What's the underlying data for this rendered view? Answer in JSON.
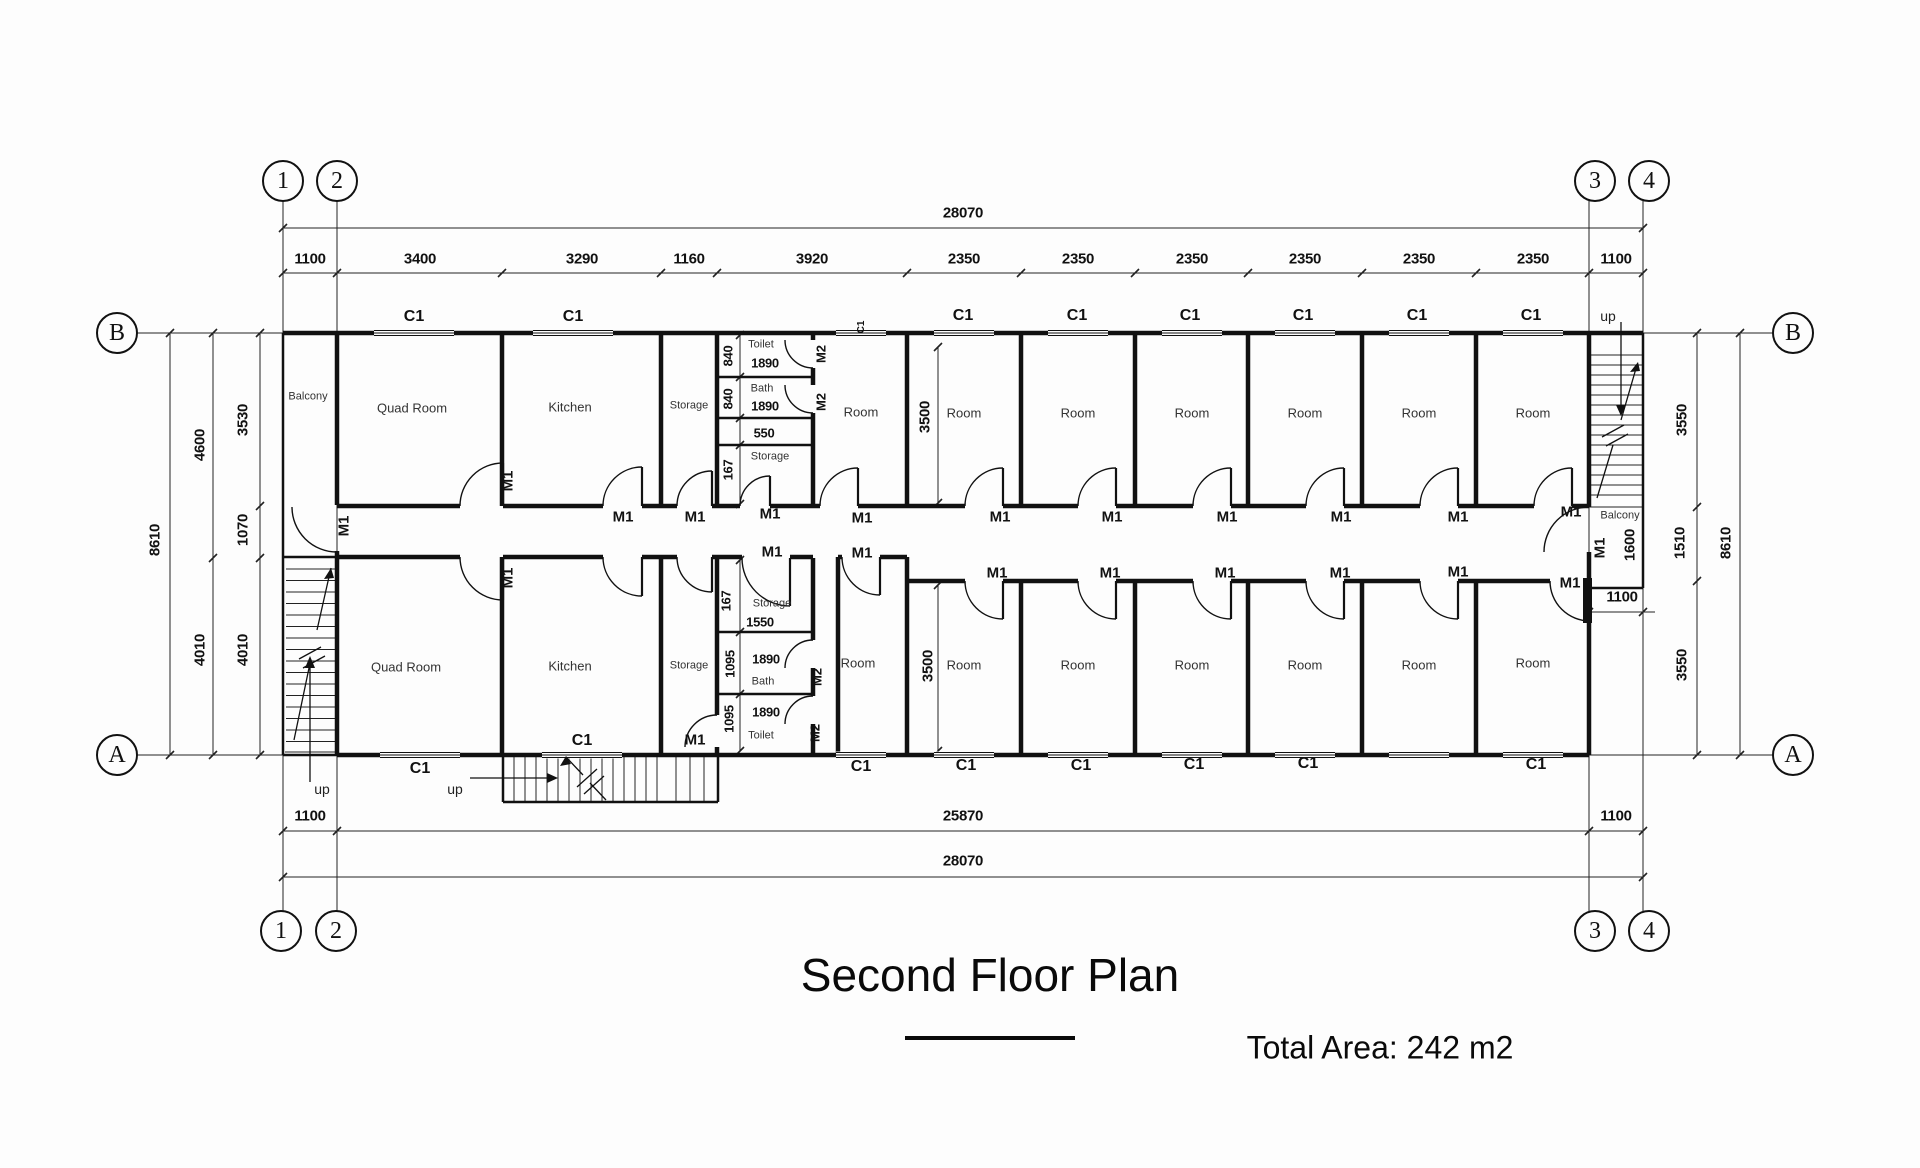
{
  "title": {
    "text": "Second Floor Plan",
    "total_area": "Total Area: 242 m2"
  },
  "plan": {
    "bubbles": [
      {
        "t": "1",
        "x": 283,
        "y": 181
      },
      {
        "t": "2",
        "x": 337,
        "y": 181
      },
      {
        "t": "3",
        "x": 1595,
        "y": 181
      },
      {
        "t": "4",
        "x": 1649,
        "y": 181
      },
      {
        "t": "1",
        "x": 281,
        "y": 931
      },
      {
        "t": "2",
        "x": 336,
        "y": 931
      },
      {
        "t": "3",
        "x": 1595,
        "y": 931
      },
      {
        "t": "4",
        "x": 1649,
        "y": 931
      },
      {
        "t": "B",
        "x": 117,
        "y": 333
      },
      {
        "t": "A",
        "x": 117,
        "y": 755
      },
      {
        "t": "B",
        "x": 1793,
        "y": 333
      },
      {
        "t": "A",
        "x": 1793,
        "y": 755
      }
    ],
    "labels": [
      {
        "t": "28070",
        "x": 963,
        "y": 213,
        "k": "d"
      },
      {
        "t": "1100",
        "x": 310,
        "y": 259,
        "k": "d"
      },
      {
        "t": "3400",
        "x": 420,
        "y": 259,
        "k": "d"
      },
      {
        "t": "3290",
        "x": 582,
        "y": 259,
        "k": "d"
      },
      {
        "t": "1160",
        "x": 689,
        "y": 259,
        "k": "d"
      },
      {
        "t": "3920",
        "x": 812,
        "y": 259,
        "k": "d"
      },
      {
        "t": "2350",
        "x": 964,
        "y": 259,
        "k": "d"
      },
      {
        "t": "2350",
        "x": 1078,
        "y": 259,
        "k": "d"
      },
      {
        "t": "2350",
        "x": 1192,
        "y": 259,
        "k": "d"
      },
      {
        "t": "2350",
        "x": 1305,
        "y": 259,
        "k": "d"
      },
      {
        "t": "2350",
        "x": 1419,
        "y": 259,
        "k": "d"
      },
      {
        "t": "2350",
        "x": 1533,
        "y": 259,
        "k": "d"
      },
      {
        "t": "1100",
        "x": 1616,
        "y": 259,
        "k": "d"
      },
      {
        "t": "8610",
        "x": 155,
        "y": 540,
        "r": -90,
        "k": "d"
      },
      {
        "t": "4600",
        "x": 200,
        "y": 445,
        "r": -90,
        "k": "d"
      },
      {
        "t": "4010",
        "x": 200,
        "y": 650,
        "r": -90,
        "k": "d"
      },
      {
        "t": "3530",
        "x": 243,
        "y": 420,
        "r": -90,
        "k": "d"
      },
      {
        "t": "1070",
        "x": 243,
        "y": 530,
        "r": -90,
        "k": "d"
      },
      {
        "t": "4010",
        "x": 243,
        "y": 650,
        "r": -90,
        "k": "d"
      },
      {
        "t": "3550",
        "x": 1682,
        "y": 420,
        "r": -90,
        "k": "d"
      },
      {
        "t": "1510",
        "x": 1680,
        "y": 543,
        "r": -90,
        "k": "d"
      },
      {
        "t": "3550",
        "x": 1682,
        "y": 665,
        "r": -90,
        "k": "d"
      },
      {
        "t": "8610",
        "x": 1726,
        "y": 543,
        "r": -90,
        "k": "d"
      },
      {
        "t": "1100",
        "x": 310,
        "y": 816,
        "k": "d"
      },
      {
        "t": "25870",
        "x": 963,
        "y": 816,
        "k": "d"
      },
      {
        "t": "1100",
        "x": 1616,
        "y": 816,
        "k": "d"
      },
      {
        "t": "28070",
        "x": 963,
        "y": 861,
        "k": "d"
      },
      {
        "t": "1100",
        "x": 1622,
        "y": 597,
        "k": "d"
      },
      {
        "t": "1600",
        "x": 1630,
        "y": 545,
        "r": -90,
        "k": "d"
      },
      {
        "t": "3500",
        "x": 925,
        "y": 417,
        "r": -90,
        "k": "d"
      },
      {
        "t": "3500",
        "x": 928,
        "y": 666,
        "r": -90,
        "k": "d"
      },
      {
        "t": "840",
        "x": 728,
        "y": 356,
        "r": -90,
        "k": "d",
        "s": 13
      },
      {
        "t": "1890",
        "x": 765,
        "y": 363,
        "k": "d",
        "s": 13
      },
      {
        "t": "840",
        "x": 728,
        "y": 399,
        "r": -90,
        "k": "d",
        "s": 13
      },
      {
        "t": "1890",
        "x": 765,
        "y": 406,
        "k": "d",
        "s": 13
      },
      {
        "t": "550",
        "x": 764,
        "y": 433,
        "k": "d",
        "s": 13
      },
      {
        "t": "167",
        "x": 728,
        "y": 470,
        "r": -90,
        "k": "d",
        "s": 13
      },
      {
        "t": "167",
        "x": 726,
        "y": 601,
        "r": -90,
        "k": "d",
        "s": 13
      },
      {
        "t": "1550",
        "x": 760,
        "y": 622,
        "k": "d",
        "s": 13
      },
      {
        "t": "1095",
        "x": 730,
        "y": 664,
        "r": -90,
        "k": "d",
        "s": 13
      },
      {
        "t": "1890",
        "x": 766,
        "y": 659,
        "k": "d",
        "s": 13
      },
      {
        "t": "1095",
        "x": 729,
        "y": 719,
        "r": -90,
        "k": "d",
        "s": 13
      },
      {
        "t": "1890",
        "x": 766,
        "y": 712,
        "k": "d",
        "s": 13
      },
      {
        "t": "Balcony",
        "x": 308,
        "y": 397,
        "k": "r",
        "s": 11
      },
      {
        "t": "Quad Room",
        "x": 412,
        "y": 408,
        "k": "r"
      },
      {
        "t": "Kitchen",
        "x": 570,
        "y": 407,
        "k": "r"
      },
      {
        "t": "Storage",
        "x": 689,
        "y": 406,
        "k": "r",
        "s": 11
      },
      {
        "t": "Room",
        "x": 861,
        "y": 412,
        "k": "r"
      },
      {
        "t": "Room",
        "x": 964,
        "y": 413,
        "k": "r"
      },
      {
        "t": "Room",
        "x": 1078,
        "y": 413,
        "k": "r"
      },
      {
        "t": "Room",
        "x": 1192,
        "y": 413,
        "k": "r"
      },
      {
        "t": "Room",
        "x": 1305,
        "y": 413,
        "k": "r"
      },
      {
        "t": "Room",
        "x": 1419,
        "y": 413,
        "k": "r"
      },
      {
        "t": "Room",
        "x": 1533,
        "y": 413,
        "k": "r"
      },
      {
        "t": "Quad Room",
        "x": 406,
        "y": 667,
        "k": "r"
      },
      {
        "t": "Kitchen",
        "x": 570,
        "y": 666,
        "k": "r"
      },
      {
        "t": "Storage",
        "x": 689,
        "y": 666,
        "k": "r",
        "s": 11
      },
      {
        "t": "Room",
        "x": 858,
        "y": 663,
        "k": "r"
      },
      {
        "t": "Room",
        "x": 964,
        "y": 665,
        "k": "r"
      },
      {
        "t": "Room",
        "x": 1078,
        "y": 665,
        "k": "r"
      },
      {
        "t": "Room",
        "x": 1192,
        "y": 665,
        "k": "r"
      },
      {
        "t": "Room",
        "x": 1305,
        "y": 665,
        "k": "r"
      },
      {
        "t": "Room",
        "x": 1419,
        "y": 665,
        "k": "r"
      },
      {
        "t": "Room",
        "x": 1533,
        "y": 663,
        "k": "r"
      },
      {
        "t": "Toilet",
        "x": 761,
        "y": 345,
        "k": "r",
        "s": 11
      },
      {
        "t": "Bath",
        "x": 762,
        "y": 389,
        "k": "r",
        "s": 11
      },
      {
        "t": "Storage",
        "x": 770,
        "y": 457,
        "k": "r",
        "s": 11
      },
      {
        "t": "Storage",
        "x": 772,
        "y": 604,
        "k": "r",
        "s": 11
      },
      {
        "t": "Bath",
        "x": 763,
        "y": 682,
        "k": "r",
        "s": 11
      },
      {
        "t": "Toilet",
        "x": 761,
        "y": 736,
        "k": "r",
        "s": 11
      },
      {
        "t": "Balcony",
        "x": 1620,
        "y": 516,
        "k": "r",
        "s": 11
      },
      {
        "t": "M1",
        "x": 623,
        "y": 517,
        "k": "m"
      },
      {
        "t": "M1",
        "x": 695,
        "y": 517,
        "k": "m"
      },
      {
        "t": "M1",
        "x": 770,
        "y": 514,
        "k": "m"
      },
      {
        "t": "M1",
        "x": 862,
        "y": 518,
        "k": "m"
      },
      {
        "t": "M1",
        "x": 1000,
        "y": 517,
        "k": "m"
      },
      {
        "t": "M1",
        "x": 1112,
        "y": 517,
        "k": "m"
      },
      {
        "t": "M1",
        "x": 1227,
        "y": 517,
        "k": "m"
      },
      {
        "t": "M1",
        "x": 1341,
        "y": 517,
        "k": "m"
      },
      {
        "t": "M1",
        "x": 1458,
        "y": 517,
        "k": "m"
      },
      {
        "t": "M1",
        "x": 1571,
        "y": 512,
        "k": "m"
      },
      {
        "t": "M1",
        "x": 772,
        "y": 552,
        "k": "m"
      },
      {
        "t": "M1",
        "x": 862,
        "y": 553,
        "k": "m"
      },
      {
        "t": "M1",
        "x": 997,
        "y": 573,
        "k": "m"
      },
      {
        "t": "M1",
        "x": 1110,
        "y": 573,
        "k": "m"
      },
      {
        "t": "M1",
        "x": 1225,
        "y": 573,
        "k": "m"
      },
      {
        "t": "M1",
        "x": 1340,
        "y": 573,
        "k": "m"
      },
      {
        "t": "M1",
        "x": 1458,
        "y": 572,
        "k": "m"
      },
      {
        "t": "M1",
        "x": 1570,
        "y": 583,
        "k": "m"
      },
      {
        "t": "M1",
        "x": 695,
        "y": 740,
        "k": "m"
      },
      {
        "t": "M1",
        "x": 344,
        "y": 526,
        "r": -90,
        "k": "m"
      },
      {
        "t": "M1",
        "x": 508,
        "y": 481,
        "r": -90,
        "k": "m"
      },
      {
        "t": "M1",
        "x": 508,
        "y": 578,
        "r": -90,
        "k": "m"
      },
      {
        "t": "M1",
        "x": 1600,
        "y": 548,
        "r": -90,
        "k": "m"
      },
      {
        "t": "M2",
        "x": 821,
        "y": 354,
        "r": -90,
        "k": "m",
        "s": 13
      },
      {
        "t": "M2",
        "x": 821,
        "y": 402,
        "r": -90,
        "k": "m",
        "s": 13
      },
      {
        "t": "M2",
        "x": 817,
        "y": 677,
        "r": -90,
        "k": "m",
        "s": 13
      },
      {
        "t": "M2",
        "x": 815,
        "y": 733,
        "r": -90,
        "k": "m",
        "s": 13
      },
      {
        "t": "C1",
        "x": 414,
        "y": 317,
        "k": "c"
      },
      {
        "t": "C1",
        "x": 573,
        "y": 317,
        "k": "c"
      },
      {
        "t": "C1",
        "x": 862,
        "y": 327,
        "r": -90,
        "k": "c",
        "s": 10
      },
      {
        "t": "C1",
        "x": 963,
        "y": 316,
        "k": "c"
      },
      {
        "t": "C1",
        "x": 1077,
        "y": 316,
        "k": "c"
      },
      {
        "t": "C1",
        "x": 1190,
        "y": 316,
        "k": "c"
      },
      {
        "t": "C1",
        "x": 1303,
        "y": 316,
        "k": "c"
      },
      {
        "t": "C1",
        "x": 1417,
        "y": 316,
        "k": "c"
      },
      {
        "t": "C1",
        "x": 1531,
        "y": 316,
        "k": "c"
      },
      {
        "t": "C1",
        "x": 420,
        "y": 769,
        "k": "c"
      },
      {
        "t": "C1",
        "x": 582,
        "y": 741,
        "k": "c"
      },
      {
        "t": "C1",
        "x": 861,
        "y": 767,
        "k": "c"
      },
      {
        "t": "C1",
        "x": 966,
        "y": 766,
        "k": "c"
      },
      {
        "t": "C1",
        "x": 1081,
        "y": 766,
        "k": "c"
      },
      {
        "t": "C1",
        "x": 1194,
        "y": 765,
        "k": "c"
      },
      {
        "t": "C1",
        "x": 1308,
        "y": 764,
        "k": "c"
      },
      {
        "t": "C1",
        "x": 1536,
        "y": 765,
        "k": "c"
      },
      {
        "t": "up",
        "x": 322,
        "y": 789,
        "k": "u"
      },
      {
        "t": "up",
        "x": 455,
        "y": 789,
        "k": "u"
      },
      {
        "t": "up",
        "x": 1608,
        "y": 316,
        "k": "u"
      }
    ]
  }
}
